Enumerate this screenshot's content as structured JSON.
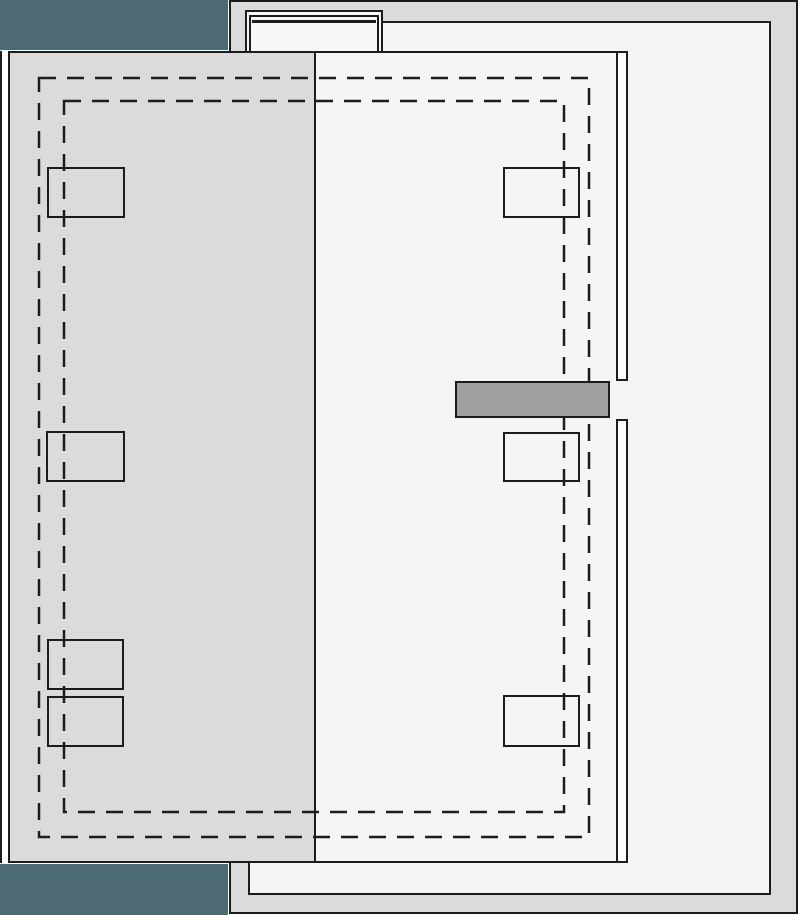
{
  "meta": {
    "type": "architectural-roof-plan",
    "canvas_width": 800,
    "canvas_height": 915
  },
  "palette": {
    "line": "#1c1c1c",
    "terrace_gray": "#dbdbdb",
    "floor_white": "#f5f5f5",
    "teal": "#4d6a73",
    "bar_gray": "#a0a0a0",
    "strip_white": "#ffffff",
    "bulkhead_white": "#f8f8f8",
    "canvas_bg": "#ffffff"
  },
  "base_shapes": [
    {
      "name": "adjacent-structure-edge-line",
      "x": 0,
      "y": 51,
      "w": 2,
      "h": 812,
      "fill": "#1c1c1c",
      "border": "none",
      "bw": 0
    },
    {
      "name": "terrace-outline",
      "x": 229,
      "y": 0,
      "w": 569,
      "h": 914,
      "fill": "#dbdbdb",
      "border": "all",
      "bw": 2
    },
    {
      "name": "upper-floor-slab",
      "x": 229,
      "y": 21,
      "w": 542,
      "h": 874,
      "fill": "#f5f5f5",
      "border": "all",
      "bw": 2.5
    },
    {
      "name": "terrace-patch-top-left",
      "x": 231,
      "y": 21,
      "w": 14,
      "h": 32,
      "fill": "#dbdbdb",
      "border": "none",
      "bw": 0
    },
    {
      "name": "stair-bulkhead-outer",
      "x": 245,
      "y": 10,
      "w": 138,
      "h": 44,
      "fill": "#f8f8f8",
      "border": "top left right",
      "bw": 2
    },
    {
      "name": "stair-bulkhead-mid",
      "x": 249,
      "y": 15,
      "w": 130,
      "h": 39,
      "fill": "transparent",
      "border": "top left right",
      "bw": 2
    },
    {
      "name": "stair-bulkhead-inner-line",
      "x": 252,
      "y": 20,
      "w": 124,
      "h": 2.5,
      "fill": "#1c1c1c",
      "border": "none",
      "bw": 0
    },
    {
      "name": "main-roof-plane",
      "x": 316,
      "y": 51,
      "w": 312,
      "h": 812,
      "fill": "#f5f5f5",
      "border": "top bottom",
      "bw": 2
    },
    {
      "name": "roof-edge-strip-upper",
      "x": 616,
      "y": 51,
      "w": 12,
      "h": 330,
      "fill": "#ffffff",
      "border": "all",
      "bw": 2
    },
    {
      "name": "roof-edge-strip-lower",
      "x": 616,
      "y": 419,
      "w": 12,
      "h": 444,
      "fill": "#ffffff",
      "border": "all",
      "bw": 2
    },
    {
      "name": "lower-roof-plane",
      "x": 8,
      "y": 51,
      "w": 308,
      "h": 812,
      "fill": "#dbdbdb",
      "border": "all",
      "bw": 2
    },
    {
      "name": "teal-block-top",
      "x": 0,
      "y": 0,
      "w": 228,
      "h": 50,
      "fill": "#4d6a73",
      "border": "none",
      "bw": 0
    },
    {
      "name": "teal-block-bottom",
      "x": 0,
      "y": 864,
      "w": 228,
      "h": 51,
      "fill": "#4d6a73",
      "border": "none",
      "bw": 0
    },
    {
      "name": "terrace-patch-bottom-left",
      "x": 231,
      "y": 863,
      "w": 19,
      "h": 32,
      "fill": "#dbdbdb",
      "border": "right",
      "bw": 2
    }
  ],
  "dashed": {
    "stroke": "#1c1c1c",
    "stroke_width": 2.5,
    "dash_array": "17 11",
    "rects": [
      {
        "name": "setback-line-outer",
        "x": 39,
        "y": 78,
        "w": 550,
        "h": 759
      },
      {
        "name": "setback-line-inner",
        "x": 64,
        "y": 101,
        "w": 500,
        "h": 711
      }
    ]
  },
  "overlay_shapes": [
    {
      "name": "skylight-left-1",
      "x": 47,
      "y": 167,
      "w": 78,
      "h": 51,
      "fill": "transparent",
      "border": "all",
      "bw": 2.5
    },
    {
      "name": "skylight-left-2",
      "x": 46,
      "y": 431,
      "w": 79,
      "h": 51,
      "fill": "transparent",
      "border": "all",
      "bw": 2.5
    },
    {
      "name": "skylight-left-3",
      "x": 47,
      "y": 639,
      "w": 77,
      "h": 51,
      "fill": "transparent",
      "border": "all",
      "bw": 2.5
    },
    {
      "name": "skylight-left-4",
      "x": 47,
      "y": 696,
      "w": 77,
      "h": 51,
      "fill": "transparent",
      "border": "all",
      "bw": 2.5
    },
    {
      "name": "skylight-right-1",
      "x": 503,
      "y": 167,
      "w": 77,
      "h": 51,
      "fill": "transparent",
      "border": "all",
      "bw": 2.5
    },
    {
      "name": "skylight-right-2",
      "x": 503,
      "y": 432,
      "w": 77,
      "h": 50,
      "fill": "transparent",
      "border": "all",
      "bw": 2.5
    },
    {
      "name": "skylight-right-3",
      "x": 503,
      "y": 695,
      "w": 77,
      "h": 52,
      "fill": "transparent",
      "border": "all",
      "bw": 2.5
    },
    {
      "name": "equipment-bar",
      "x": 455,
      "y": 381,
      "w": 155,
      "h": 37,
      "fill": "#a0a0a0",
      "border": "all",
      "bw": 2
    }
  ]
}
